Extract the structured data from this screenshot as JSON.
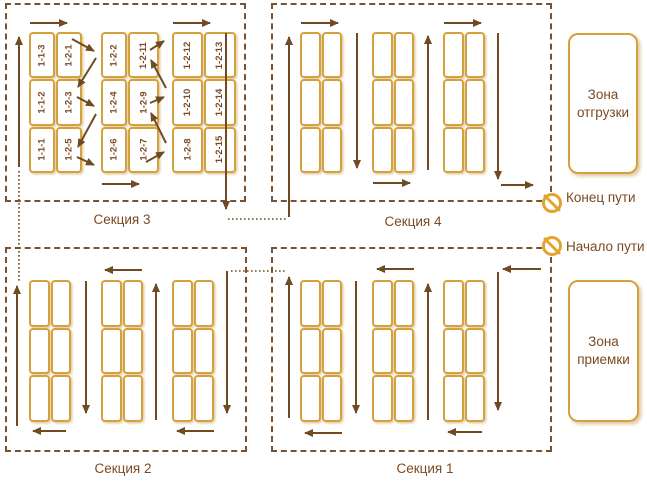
{
  "diagram": {
    "kind": "warehouse-picking-route-scheme",
    "colors": {
      "rack_gold": "#D5A13C",
      "route_brown": "#6F4A23",
      "border_brown": "#7B5230",
      "text_brown": "#7B4A21",
      "icon_gold": "#E2A42F"
    }
  },
  "sections": [
    {
      "label": "Секция 3",
      "racks": [
        {
          "cells": [
            [
              "1-1-3",
              "1-2-1"
            ],
            [
              "1-1-2",
              "1-2-3"
            ],
            [
              "1-1-1",
              "1-2-5"
            ]
          ]
        },
        {
          "cells": [
            [
              "1-2-2",
              "1-2-11"
            ],
            [
              "1-2-4",
              "1-2-9"
            ],
            [
              "1-2-6",
              "1-2-7"
            ]
          ]
        },
        {
          "cells": [
            [
              "1-2-12",
              "1-2-13"
            ],
            [
              "1-2-10",
              "1-2-14"
            ],
            [
              "1-2-8",
              "1-2-15"
            ]
          ]
        }
      ]
    },
    {
      "label": "Секция 4"
    },
    {
      "label": "Секция 2"
    },
    {
      "label": "Секция 1"
    }
  ],
  "zones": [
    {
      "label": "Зона отгрузки"
    },
    {
      "label": "Зона приемки"
    }
  ],
  "markers": [
    {
      "label": "Конец пути",
      "icon": "no-entry-icon"
    },
    {
      "label": "Начало пути",
      "icon": "no-entry-icon"
    }
  ]
}
